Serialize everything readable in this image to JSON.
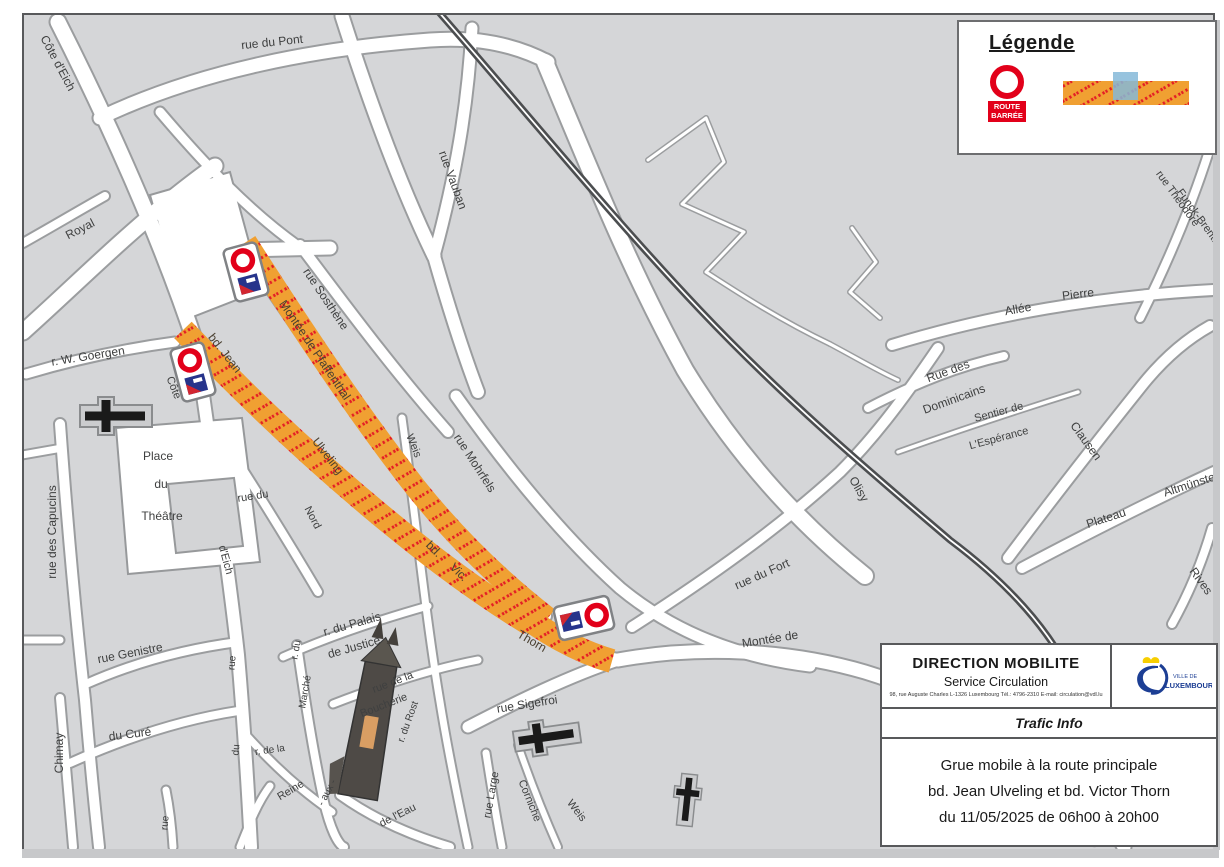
{
  "legend": {
    "title": "Légende",
    "route_barree_line1": "ROUTE",
    "route_barree_line2": "BARRÉE"
  },
  "info_box": {
    "org": "DIRECTION MOBILITE",
    "dept": "Service Circulation",
    "contact": "98, rue Auguste Charles L-1326 Luxembourg      Tél.: 4796-2310      E-mail: circulation@vdl.lu",
    "logo_line1": "VILLE DE",
    "logo_line2": "LUXEMBOURG",
    "section_title": "Trafic Info",
    "message_lines": [
      "Grue mobile à la route principale",
      "bd. Jean Ulveling et bd. Victor Thorn",
      "du 11/05/2025 de 06h00 à 20h00"
    ]
  },
  "map": {
    "closed_streets": [
      "Montée de Pfaffenthal",
      "bd. Jean Ulveling",
      "bd. Victor Thorn"
    ],
    "street_labels": [
      {
        "t": "Côte d'Eich",
        "x": 58,
        "y": 63,
        "r": 62,
        "s": 12
      },
      {
        "t": "rue du Pont",
        "x": 272,
        "y": 42,
        "r": -6,
        "s": 12
      },
      {
        "t": "Royal",
        "x": 80,
        "y": 229,
        "r": -27,
        "s": 12
      },
      {
        "t": "rue Vauban",
        "x": 453,
        "y": 180,
        "r": 70,
        "s": 12
      },
      {
        "t": "r. W. Goergen",
        "x": 88,
        "y": 356,
        "r": -9,
        "s": 12
      },
      {
        "t": "Côte",
        "x": 173,
        "y": 388,
        "r": 68,
        "s": 11
      },
      {
        "t": "d'Eich",
        "x": 225,
        "y": 560,
        "r": 75,
        "s": 11
      },
      {
        "t": "rue du",
        "x": 253,
        "y": 497,
        "r": -9,
        "s": 11
      },
      {
        "t": "Nord",
        "x": 312,
        "y": 518,
        "r": 62,
        "s": 11
      },
      {
        "t": "rue des Capucins",
        "x": 52,
        "y": 532,
        "r": -90,
        "s": 12
      },
      {
        "t": "Place",
        "x": 158,
        "y": 456,
        "r": 0,
        "s": 12
      },
      {
        "t": "du",
        "x": 161,
        "y": 484,
        "r": 0,
        "s": 12
      },
      {
        "t": "Théâtre",
        "x": 162,
        "y": 516,
        "r": 0,
        "s": 12
      },
      {
        "t": "rue Genistre",
        "x": 130,
        "y": 653,
        "r": -11,
        "s": 12
      },
      {
        "t": "du Curé",
        "x": 130,
        "y": 734,
        "r": -7,
        "s": 12
      },
      {
        "t": "Chimay",
        "x": 59,
        "y": 753,
        "r": -90,
        "s": 12
      },
      {
        "t": "rue",
        "x": 233,
        "y": 663,
        "r": -85,
        "s": 10
      },
      {
        "t": "du",
        "x": 237,
        "y": 750,
        "r": -85,
        "s": 10
      },
      {
        "t": "rue",
        "x": 166,
        "y": 823,
        "r": -85,
        "s": 10
      },
      {
        "t": "r. du",
        "x": 297,
        "y": 650,
        "r": -80,
        "s": 10
      },
      {
        "t": "Marché",
        "x": 306,
        "y": 692,
        "r": -80,
        "s": 10
      },
      {
        "t": "r. de la",
        "x": 270,
        "y": 751,
        "r": -8,
        "s": 10
      },
      {
        "t": "Reine",
        "x": 291,
        "y": 791,
        "r": -31,
        "s": 11
      },
      {
        "t": "- aux -",
        "x": 328,
        "y": 793,
        "r": -62,
        "s": 10
      },
      {
        "t": "de l'Eau",
        "x": 398,
        "y": 816,
        "r": -27,
        "s": 11
      },
      {
        "t": "r. du Rost",
        "x": 409,
        "y": 722,
        "r": -70,
        "s": 10
      },
      {
        "t": "r. du Palais",
        "x": 352,
        "y": 624,
        "r": -16,
        "s": 12
      },
      {
        "t": "de Justice",
        "x": 354,
        "y": 647,
        "r": -16,
        "s": 12
      },
      {
        "t": "rue de la",
        "x": 393,
        "y": 683,
        "r": -21,
        "s": 11
      },
      {
        "t": "Boucherie",
        "x": 384,
        "y": 706,
        "r": -21,
        "s": 11
      },
      {
        "t": "rue Sigefroi",
        "x": 527,
        "y": 704,
        "r": -9,
        "s": 12
      },
      {
        "t": "rue Large",
        "x": 492,
        "y": 795,
        "r": -80,
        "s": 11
      },
      {
        "t": "Corniche",
        "x": 529,
        "y": 801,
        "r": 68,
        "s": 11
      },
      {
        "t": "Weis",
        "x": 576,
        "y": 811,
        "r": 52,
        "s": 11
      },
      {
        "t": "Weis",
        "x": 413,
        "y": 446,
        "r": 68,
        "s": 11
      },
      {
        "t": "rue Mohrfels",
        "x": 475,
        "y": 463,
        "r": 57,
        "s": 12
      },
      {
        "t": "rue Sosthène",
        "x": 326,
        "y": 299,
        "r": 56,
        "s": 12
      },
      {
        "t": "Montée de Pfaffenthal",
        "x": 315,
        "y": 350,
        "r": 56,
        "s": 12,
        "c": "#4A4031"
      },
      {
        "t": "bd. Jean",
        "x": 225,
        "y": 353,
        "r": 52,
        "s": 12,
        "c": "#4A4031"
      },
      {
        "t": "Ulveling",
        "x": 328,
        "y": 456,
        "r": 52,
        "s": 12,
        "c": "#4A4031"
      },
      {
        "t": "bd.",
        "x": 434,
        "y": 549,
        "r": 45,
        "s": 12,
        "c": "#4A4031"
      },
      {
        "t": "Vic.",
        "x": 459,
        "y": 572,
        "r": 45,
        "s": 12,
        "c": "#4A4031"
      },
      {
        "t": "Thorn",
        "x": 532,
        "y": 641,
        "r": 30,
        "s": 12,
        "c": "#4A4031"
      },
      {
        "t": "rue du Fort",
        "x": 762,
        "y": 574,
        "r": -24,
        "s": 12
      },
      {
        "t": "Montée  de",
        "x": 770,
        "y": 639,
        "r": -9,
        "s": 12
      },
      {
        "t": "Olisy",
        "x": 859,
        "y": 489,
        "r": 60,
        "s": 12
      },
      {
        "t": "Allée",
        "x": 1018,
        "y": 309,
        "r": -10,
        "s": 12
      },
      {
        "t": "Pierre",
        "x": 1078,
        "y": 294,
        "r": -7,
        "s": 12
      },
      {
        "t": "Rue des",
        "x": 948,
        "y": 371,
        "r": -20,
        "s": 12
      },
      {
        "t": "Dominicains",
        "x": 954,
        "y": 399,
        "r": -20,
        "s": 12
      },
      {
        "t": "Sentier de",
        "x": 999,
        "y": 413,
        "r": -15,
        "s": 11
      },
      {
        "t": "L'Espérance",
        "x": 999,
        "y": 439,
        "r": -15,
        "s": 11
      },
      {
        "t": "Clausen",
        "x": 1086,
        "y": 441,
        "r": 54,
        "s": 12
      },
      {
        "t": "Plateau",
        "x": 1106,
        "y": 518,
        "r": -18,
        "s": 12
      },
      {
        "t": "Altmünster",
        "x": 1191,
        "y": 484,
        "r": -18,
        "s": 12
      },
      {
        "t": "Rives",
        "x": 1201,
        "y": 581,
        "r": 54,
        "s": 12
      },
      {
        "t": "rue Théodore",
        "x": 1177,
        "y": 199,
        "r": 54,
        "s": 11
      },
      {
        "t": "Funck-Brent.",
        "x": 1197,
        "y": 216,
        "r": 54,
        "s": 11
      }
    ]
  }
}
